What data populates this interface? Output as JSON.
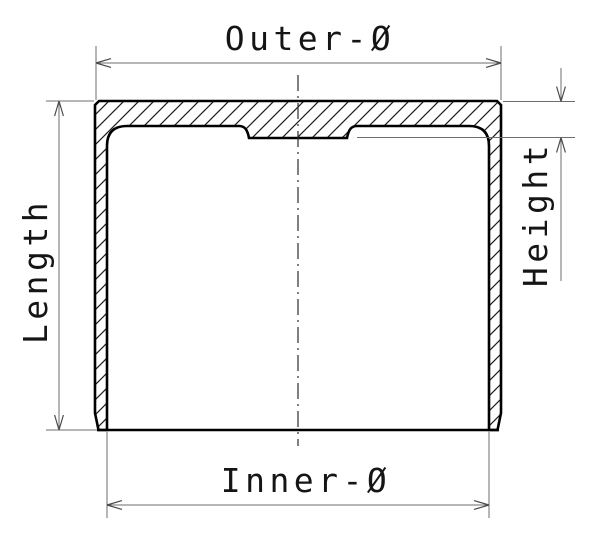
{
  "drawing": {
    "type": "technical-cross-section",
    "subject": "valve-tappet-cup-section",
    "labels": {
      "outer_diameter": "Outer-Ø",
      "inner_diameter": "Inner-Ø",
      "length": "Length",
      "height": "Height"
    },
    "colors": {
      "background": "#ffffff",
      "outline": "#000000",
      "dimension_lines": "#6e6e6e",
      "text": "#151515"
    }
  }
}
